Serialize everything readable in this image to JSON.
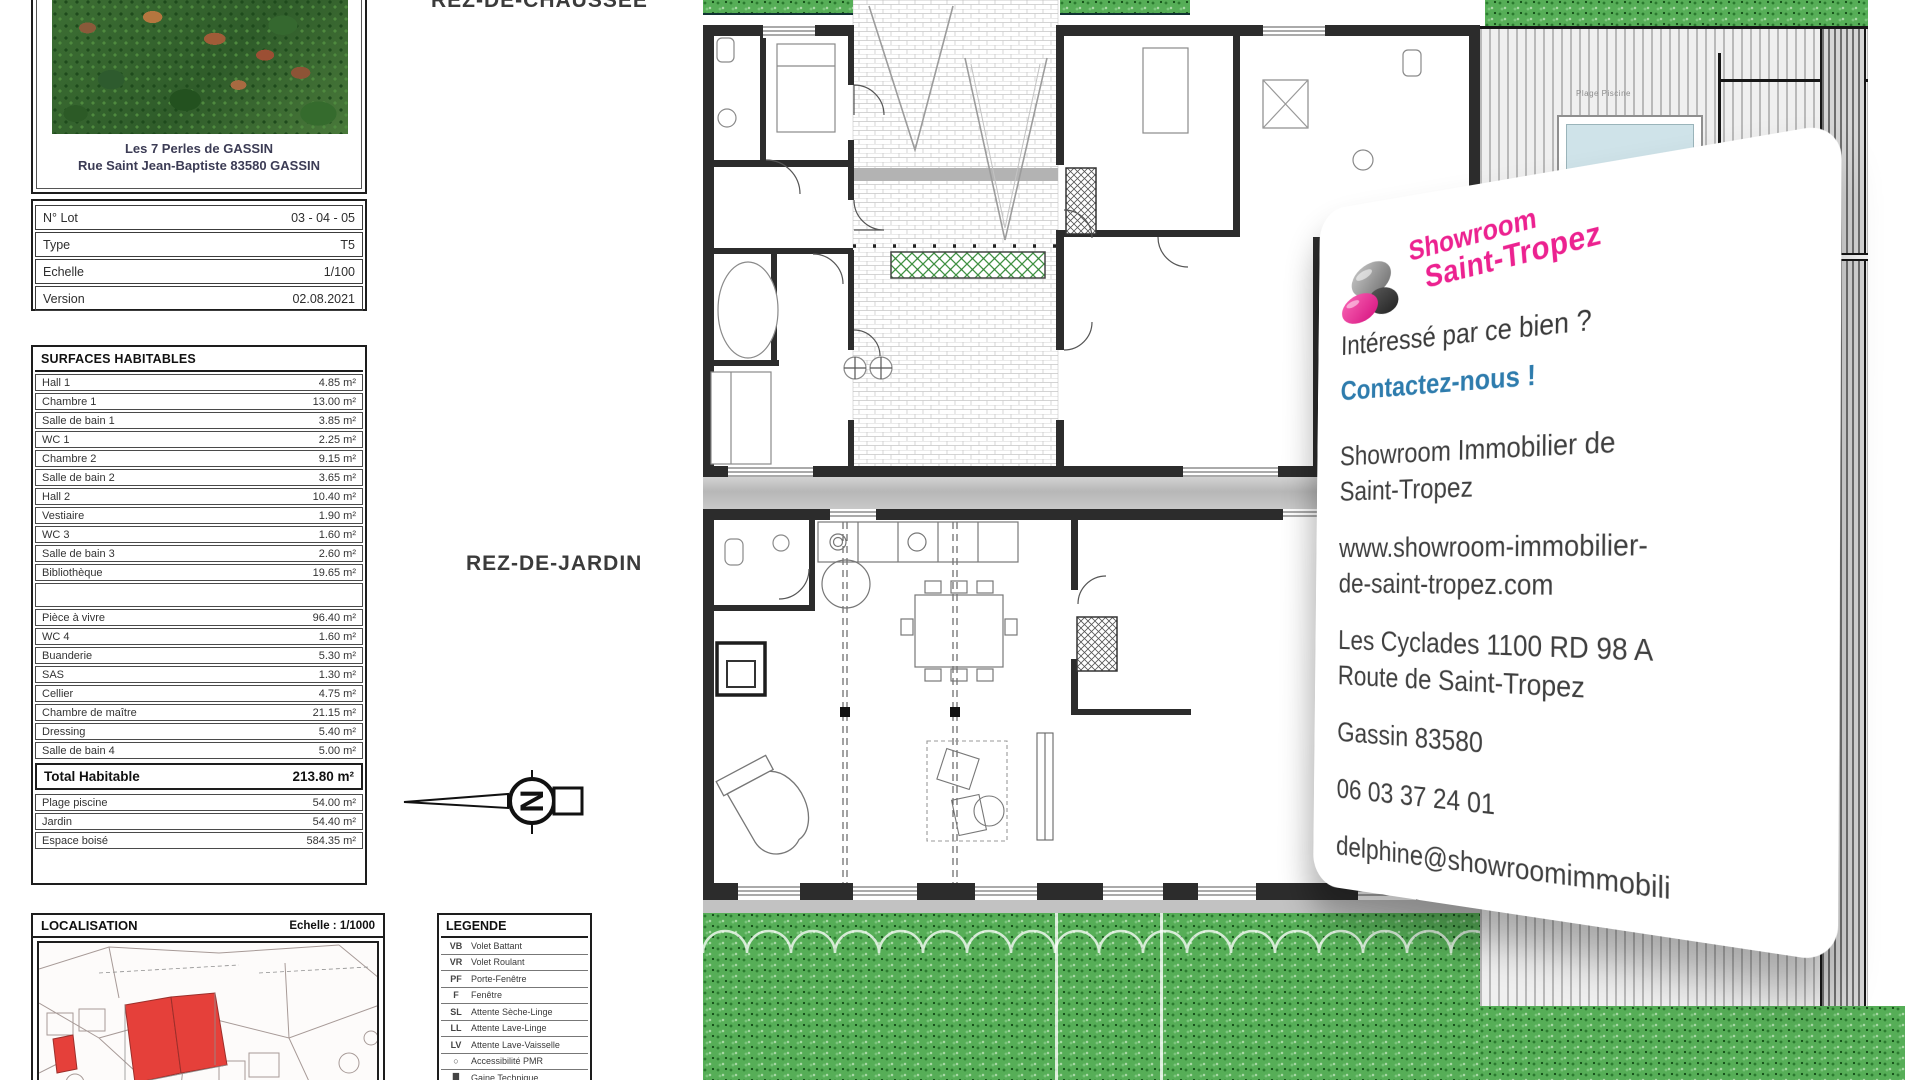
{
  "sidebar": {
    "photo_caption_line1": "Les 7 Perles de GASSIN",
    "photo_caption_line2": "Rue Saint Jean-Baptiste 83580 GASSIN",
    "info_rows": [
      {
        "label": "N° Lot",
        "value": "03 - 04 - 05"
      },
      {
        "label": "Type",
        "value": "T5"
      },
      {
        "label": "Echelle",
        "value": "1/100"
      },
      {
        "label": "Version",
        "value": "02.08.2021"
      }
    ],
    "surfaces": {
      "title": "SURFACES HABITABLES",
      "rows_group1": [
        {
          "label": "Hall 1",
          "value": "4.85 m²"
        },
        {
          "label": "Chambre 1",
          "value": "13.00 m²"
        },
        {
          "label": "Salle de bain 1",
          "value": "3.85 m²"
        },
        {
          "label": "WC 1",
          "value": "2.25 m²"
        },
        {
          "label": "Chambre 2",
          "value": "9.15 m²"
        },
        {
          "label": "Salle de bain 2",
          "value": "3.65 m²"
        },
        {
          "label": "Hall 2",
          "value": "10.40 m²"
        },
        {
          "label": "Vestiaire",
          "value": "1.90 m²"
        },
        {
          "label": "WC 3",
          "value": "1.60 m²"
        },
        {
          "label": "Salle de bain 3",
          "value": "2.60 m²"
        },
        {
          "label": "Bibliothèque",
          "value": "19.65 m²"
        }
      ],
      "rows_group2": [
        {
          "label": "Pièce à vivre",
          "value": "96.40 m²"
        },
        {
          "label": "WC 4",
          "value": "1.60 m²"
        },
        {
          "label": "Buanderie",
          "value": "5.30 m²"
        },
        {
          "label": "SAS",
          "value": "1.30 m²"
        },
        {
          "label": "Cellier",
          "value": "4.75 m²"
        },
        {
          "label": "Chambre de maître",
          "value": "21.15 m²"
        },
        {
          "label": "Dressing",
          "value": "5.40 m²"
        },
        {
          "label": "Salle de bain 4",
          "value": "5.00 m²"
        }
      ],
      "total": {
        "label": "Total Habitable",
        "value": "213.80 m²"
      },
      "outdoor_rows": [
        {
          "label": "Plage piscine",
          "value": "54.00 m²"
        },
        {
          "label": "Jardin",
          "value": "54.40 m²"
        },
        {
          "label": "Espace boisé",
          "value": "584.35 m²"
        }
      ]
    },
    "localisation": {
      "title": "LOCALISATION",
      "scale": "Echelle : 1/1000"
    },
    "legende": {
      "title": "LEGENDE",
      "rows": [
        {
          "code": "VB",
          "label": "Volet Battant"
        },
        {
          "code": "VR",
          "label": "Volet Roulant"
        },
        {
          "code": "PF",
          "label": "Porte-Fenêtre"
        },
        {
          "code": "F",
          "label": "Fenêtre"
        },
        {
          "code": "SL",
          "label": "Attente Sèche-Linge"
        },
        {
          "code": "LL",
          "label": "Attente Lave-Linge"
        },
        {
          "code": "LV",
          "label": "Attente Lave-Vaisselle"
        },
        {
          "code": "○",
          "label": "Accessibilité PMR"
        },
        {
          "code": "█",
          "label": "Gaine Technique"
        }
      ]
    }
  },
  "plans": {
    "ground_floor_label": "REZ-DE-CHAUSSEE",
    "garden_floor_label": "REZ-DE-JARDIN",
    "pool_deck_label": "Plage Piscine",
    "north_letter": "N"
  },
  "card": {
    "logo_line1": "Showroom",
    "logo_line2": "Saint-Tropez",
    "interest_line": "Intéressé par ce bien ?",
    "cta": "Contactez-nous !",
    "agency_line1": "Showroom Immobilier de",
    "agency_line2": "Saint-Tropez",
    "website_line1": "www.showroom-immobilier-",
    "website_line2": "de-saint-tropez.com",
    "address_line1": "Les Cyclades 1100 RD 98 A",
    "address_line2": "Route de Saint-Tropez",
    "city": "Gassin 83580",
    "phone": "06 03 37 24 01",
    "email": "delphine@showroomimmobili",
    "colors": {
      "pink": "#ec2290",
      "blue": "#2e7cad"
    }
  }
}
